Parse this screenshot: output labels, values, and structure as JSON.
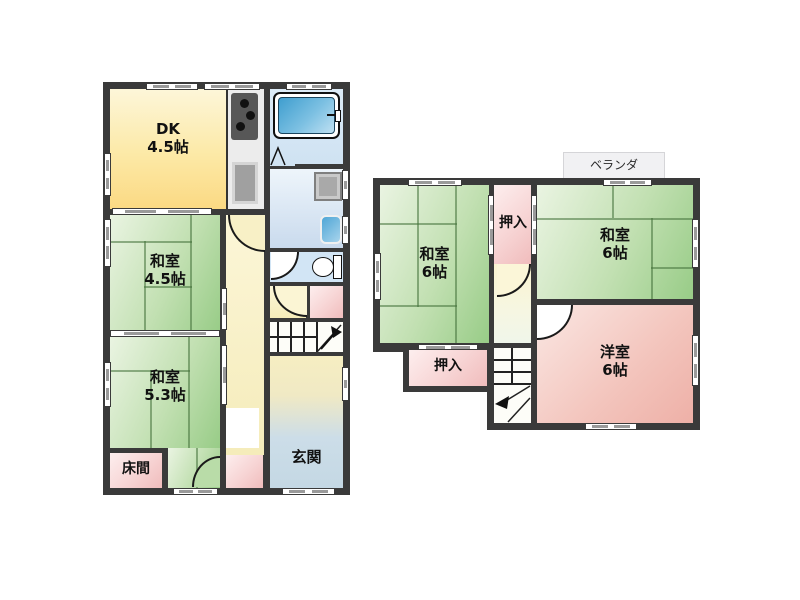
{
  "floor1": {
    "rooms": {
      "dk": {
        "name": "DK",
        "size": "4.5帖"
      },
      "washitsu_45": {
        "name": "和室",
        "size": "4.5帖"
      },
      "washitsu_53": {
        "name": "和室",
        "size": "5.3帖"
      },
      "tokonoma": {
        "name": "床間"
      },
      "genkan": {
        "name": "玄関"
      }
    }
  },
  "floor2": {
    "veranda": {
      "name": "ベランダ"
    },
    "rooms": {
      "washitsu_left": {
        "name": "和室",
        "size": "6帖"
      },
      "washitsu_right": {
        "name": "和室",
        "size": "6帖"
      },
      "youshitsu": {
        "name": "洋室",
        "size": "6帖"
      },
      "oshiire_upper": {
        "name": "押入"
      },
      "oshiire_lower": {
        "name": "押入"
      }
    }
  },
  "palette": {
    "wall": "#3a3a3a",
    "tatami_green": "#98cc87",
    "dk_yellow": "#fbd983",
    "western_pink": "#eeb0a7",
    "closet_pink": "#f0bcbc",
    "water_blue": "#cfe2f2",
    "tub_blue": "#3f9ecf",
    "hall_yellow": "#f5ecba",
    "genkan_blue": "#c4d8e4"
  }
}
